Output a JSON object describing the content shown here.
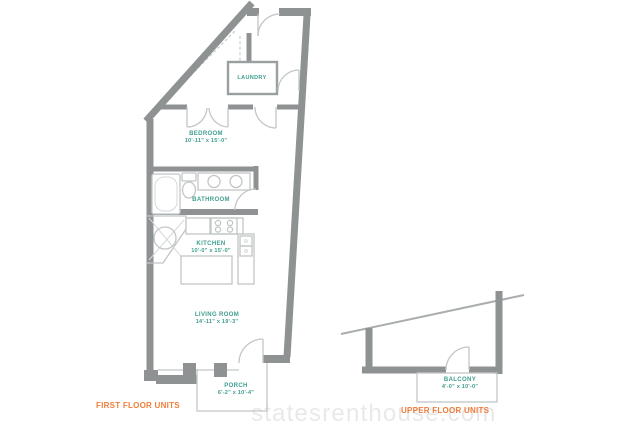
{
  "rooms": [
    {
      "id": "laundry",
      "name": "LAUNDRY",
      "dims": ""
    },
    {
      "id": "bedroom",
      "name": "BEDROOM",
      "dims": "10'-11\" x 15'-0\""
    },
    {
      "id": "bathroom",
      "name": "BATHROOM",
      "dims": ""
    },
    {
      "id": "kitchen",
      "name": "KITCHEN",
      "dims": "10'-0\" x 15'-0\""
    },
    {
      "id": "living-room",
      "name": "LIVING ROOM",
      "dims": "14'-11\" x 19'-3\""
    },
    {
      "id": "porch",
      "name": "PORCH",
      "dims": "6'-2\" x 10'-4\""
    },
    {
      "id": "balcony",
      "name": "BALCONY",
      "dims": "4'-0\" x 10'-0\""
    }
  ],
  "floor_labels": {
    "first": "FIRST FLOOR UNITS",
    "upper": "UPPER FLOOR UNITS"
  },
  "watermark": "statesrenthouse.com",
  "colors": {
    "wall": "#8f9293",
    "fixture_line": "#c2c6c7",
    "room_label": "#3f9e8e",
    "floor_label": "#ef7d3a",
    "watermark": "#e9e9e9"
  }
}
